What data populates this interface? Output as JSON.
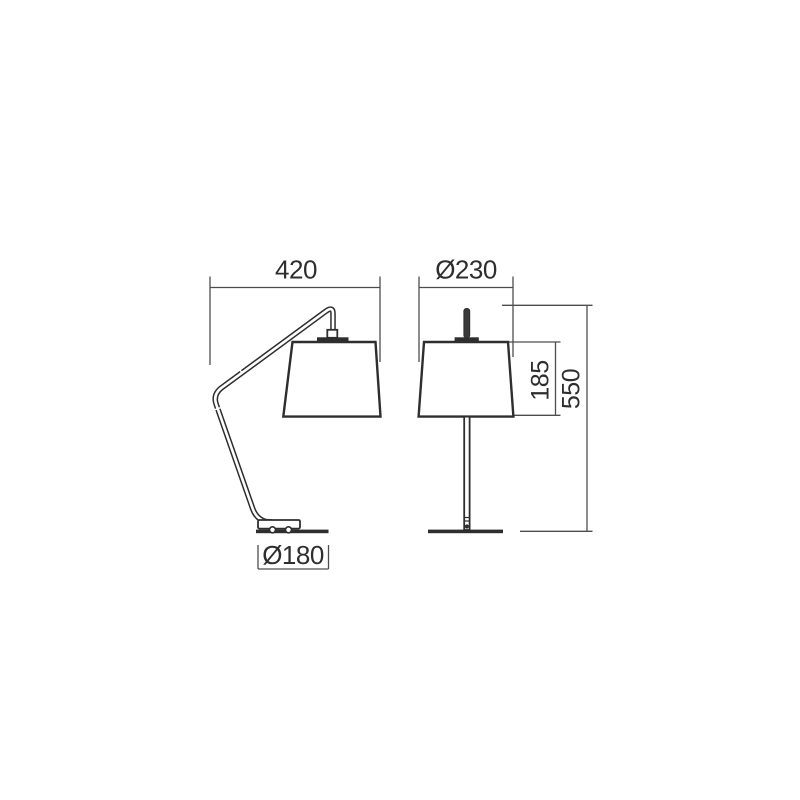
{
  "drawing": {
    "product": "Table lamp technical dimension drawing",
    "views": {
      "side": {
        "arm_reach": {
          "label": "420",
          "value": 420
        },
        "base_diameter": {
          "label": "Ø180",
          "value": 180
        }
      },
      "front": {
        "shade_diameter": {
          "label": "Ø230",
          "value": 230
        },
        "shade_height": {
          "label": "185",
          "value": 185
        },
        "total_height": {
          "label": "550",
          "value": 550
        }
      }
    },
    "colors": {
      "line": "#2e2e2e",
      "dimension": "#4d4d4d",
      "background": "#ffffff"
    }
  }
}
